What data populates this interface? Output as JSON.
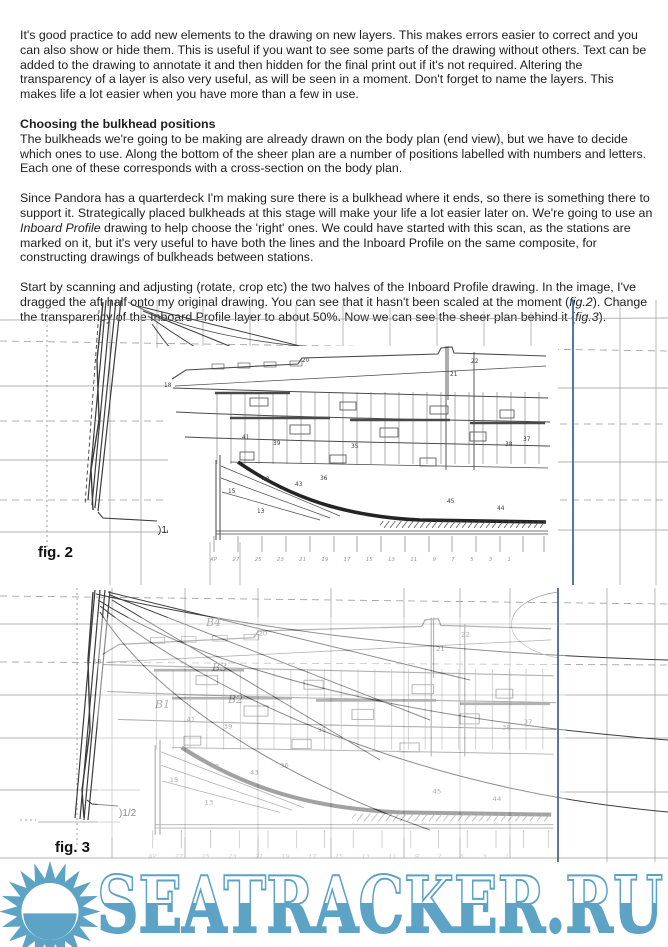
{
  "content": {
    "p1": "It's good practice to add new elements to the drawing on new layers. This makes errors easier to correct and you can also show or hide them. This is useful if you want to see some parts of the drawing without others. Text can be added to the drawing to annotate it and then hidden for the final print out if it's not required.  Altering the transparency of a layer is also very useful, as will be seen in a moment. Don't forget to name the layers. This makes life a lot easier when you have more than a few in use.",
    "heading": "Choosing the bulkhead positions",
    "p2": "The bulkheads we're going to be making are already drawn on the body plan (end view), but we have to decide which ones to use. Along the bottom of the sheer plan are a number of positions labelled with numbers and letters. Each one of these corresponds with a cross-section on the body plan.",
    "p3a": "Since Pandora has a quarterdeck I'm making sure there is a bulkhead where it ends, so there is something there to support it. Strategically placed bulkheads at this stage will make your life a lot easier later on. We're going to use an ",
    "p3b": "Inboard Profile",
    "p3c": " drawing to help choose the 'right' ones. We could have started with this scan, as the stations are marked on it, but it's very useful to have both the lines and the Inboard Profile on the same composite, for constructing drawings of bulkheads between stations.",
    "p4a": "Start by scanning and adjusting (rotate, crop etc) the two halves of the Inboard Profile drawing. In the image, I've dragged the aft half onto my original drawing. You can see that it hasn't been scaled at the moment (",
    "p4b": "fig.2",
    "p4c": "). Change the transparency of the Inboard Profile layer to about 50%. Now we can see the sheer plan behind it (",
    "p4d": "fig.3",
    "p4e": ")."
  },
  "fig2": {
    "caption": "fig. 2",
    "half_mark": ")1/2",
    "stations": "AP 27 25 23 21 19 17 15 13 11 9 7 5 3 1",
    "numbers": [
      "18",
      "21",
      "22",
      "20",
      "41",
      "39",
      "35",
      "37",
      "38",
      "42",
      "43",
      "36",
      "44",
      "45",
      "15",
      "13"
    ]
  },
  "fig3": {
    "caption": "fig. 3",
    "half_mark": ")1/2",
    "curve_labels": [
      "B4",
      "B3",
      "B2",
      "B1"
    ]
  },
  "watermark": {
    "text": "SEATRACKER.RU",
    "color": "#5da3c6"
  },
  "colors": {
    "guide_blue": "#44679b",
    "grid_gray": "#9b9b9b",
    "ink": "#3b3b3b"
  }
}
